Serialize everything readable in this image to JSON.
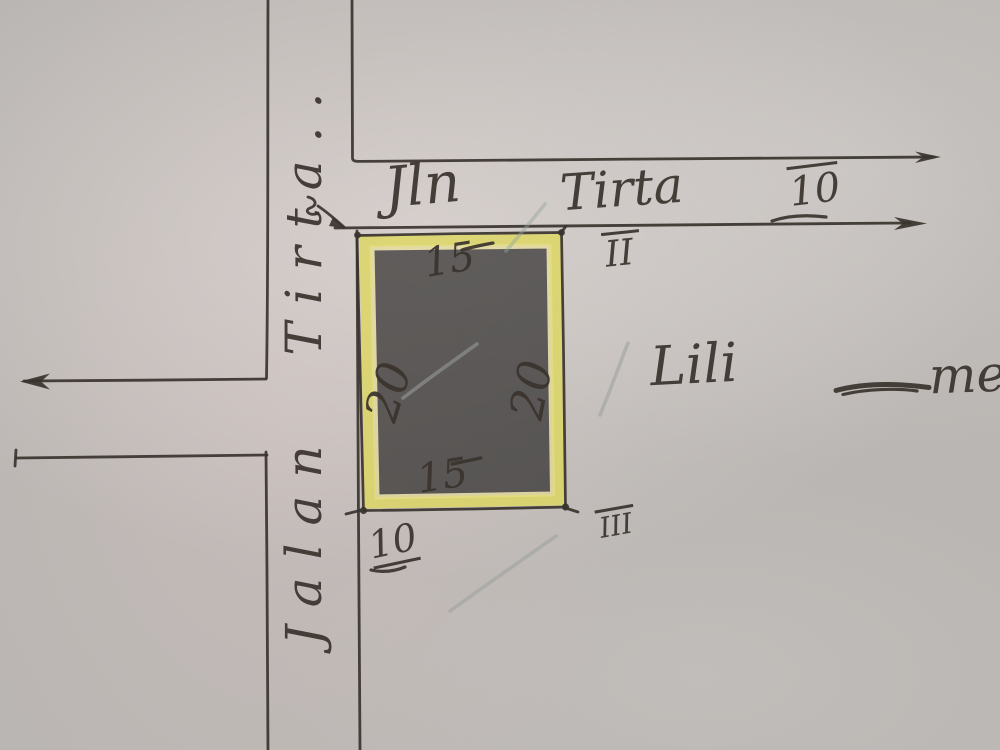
{
  "palette": {
    "paper": "#bab6b3",
    "ink": "#3a332e",
    "highlight": "#ddd75f",
    "pencil": "#9ba19f"
  },
  "streets": {
    "horizontal_label_word1": "Jln",
    "horizontal_label_word2": "Tirta",
    "horizontal_label_number": "10",
    "vertical_label": "Jalan Tirta.."
  },
  "plot": {
    "dim_top": "15",
    "dim_left": "20",
    "dim_right": "20",
    "dim_bottom": "15"
  },
  "annotations": {
    "parcel_numeral_street": "II",
    "parcel_numeral_below": "III",
    "frontage_number": "10",
    "name": "Lili",
    "name_tail": "me"
  }
}
